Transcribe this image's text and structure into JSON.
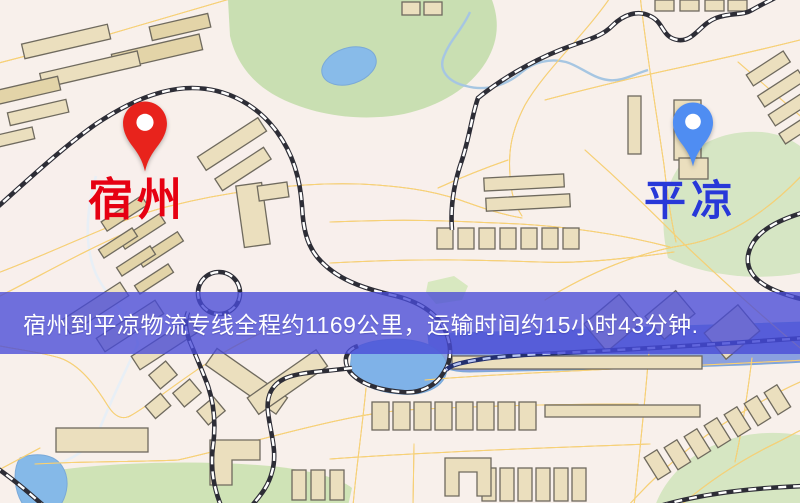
{
  "banner": {
    "text": "宿州到平凉物流专线全程约1169公里，运输时间约15小时43分钟.",
    "background_color": "rgba(72,74,215,0.78)",
    "text_color": "#ffffff"
  },
  "markers": {
    "origin": {
      "label": "宿州",
      "pin_color": "#e8231c",
      "label_color": "#e60012"
    },
    "destination": {
      "label": "平凉",
      "pin_color": "#4f8df2",
      "label_color": "#2838d8"
    }
  },
  "map_palette": {
    "background": "#f8f0eb",
    "road_fill": "#f8d376",
    "road_casing": "#eab158",
    "building": "#ebdfbe",
    "green_area": "#cde1b5",
    "water": "#85b9e8",
    "railway": "#2d2d36",
    "river_under_banner": "#8aa0e0"
  }
}
